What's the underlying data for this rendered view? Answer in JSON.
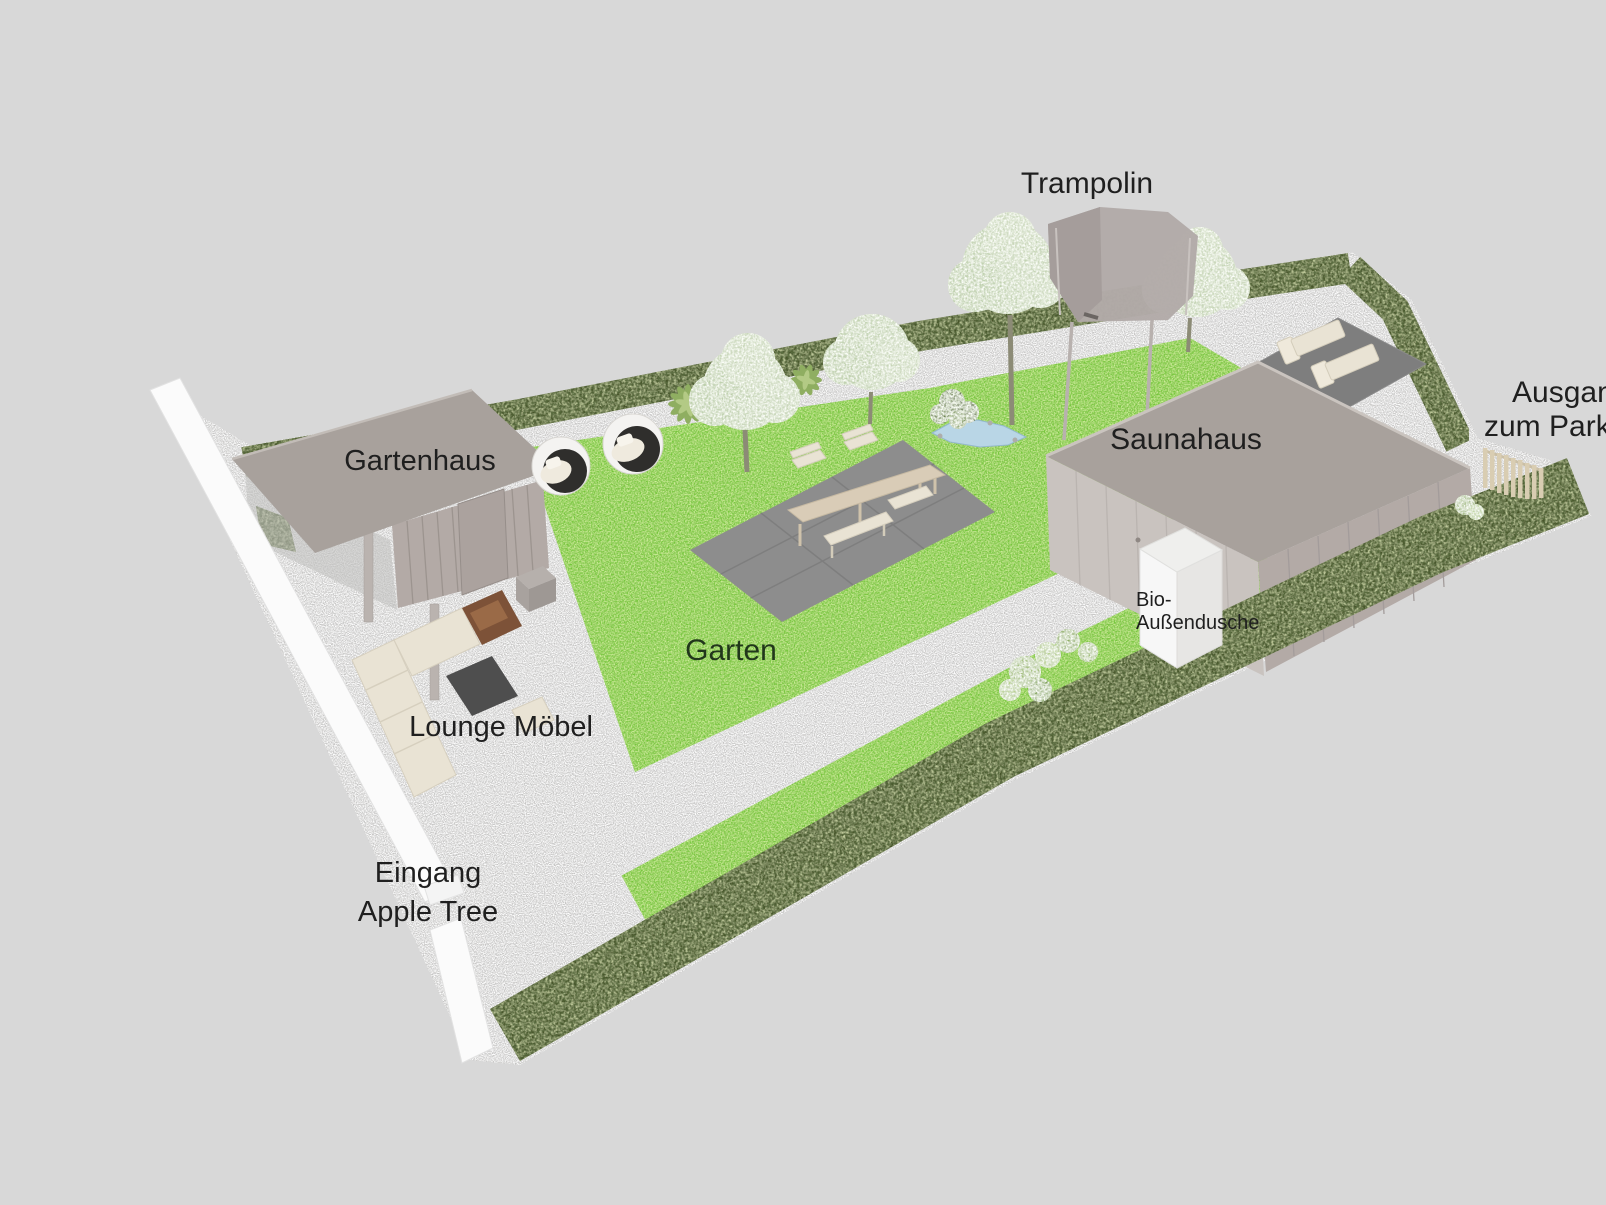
{
  "scene": {
    "description": "3D garden landscaping plan, isometric render on gray background",
    "background": "#d8d8d8",
    "labels": {
      "trampolin": "Trampolin",
      "gartenhaus": "Gartenhaus",
      "saunahaus": "Saunahaus",
      "garten": "Garten",
      "lounge": "Lounge Möbel",
      "eingang_line1": "Eingang",
      "eingang_line2": "Apple Tree",
      "shower_line1": "Bio-",
      "shower_line2": "Außendusche",
      "ausgang_line1": "Ausgang",
      "ausgang_line2": "zum Parkpl"
    },
    "colors": {
      "bg": "#d8d8d8",
      "gravel": "#c9c8c6",
      "lawn": "#73c637",
      "hedge": "#46542c",
      "roof": "#a8a19c",
      "building_wall": "#b3aaa6",
      "building_wall_light": "#c9c3bf",
      "patio": "#8d8d8d",
      "terrace": "#7e7e7e",
      "white_wall": "#fbfbfb",
      "wood": "#d9ccb7",
      "wood_dark": "#7d5238",
      "cream": "#e9e3d4",
      "dark_table": "#4e4e4e",
      "water": "#b9d6e6",
      "foliage": "#c6d6b7",
      "fence": "#d9cdb2",
      "label": "#1f1f1f",
      "label_green": "#21371b"
    }
  }
}
